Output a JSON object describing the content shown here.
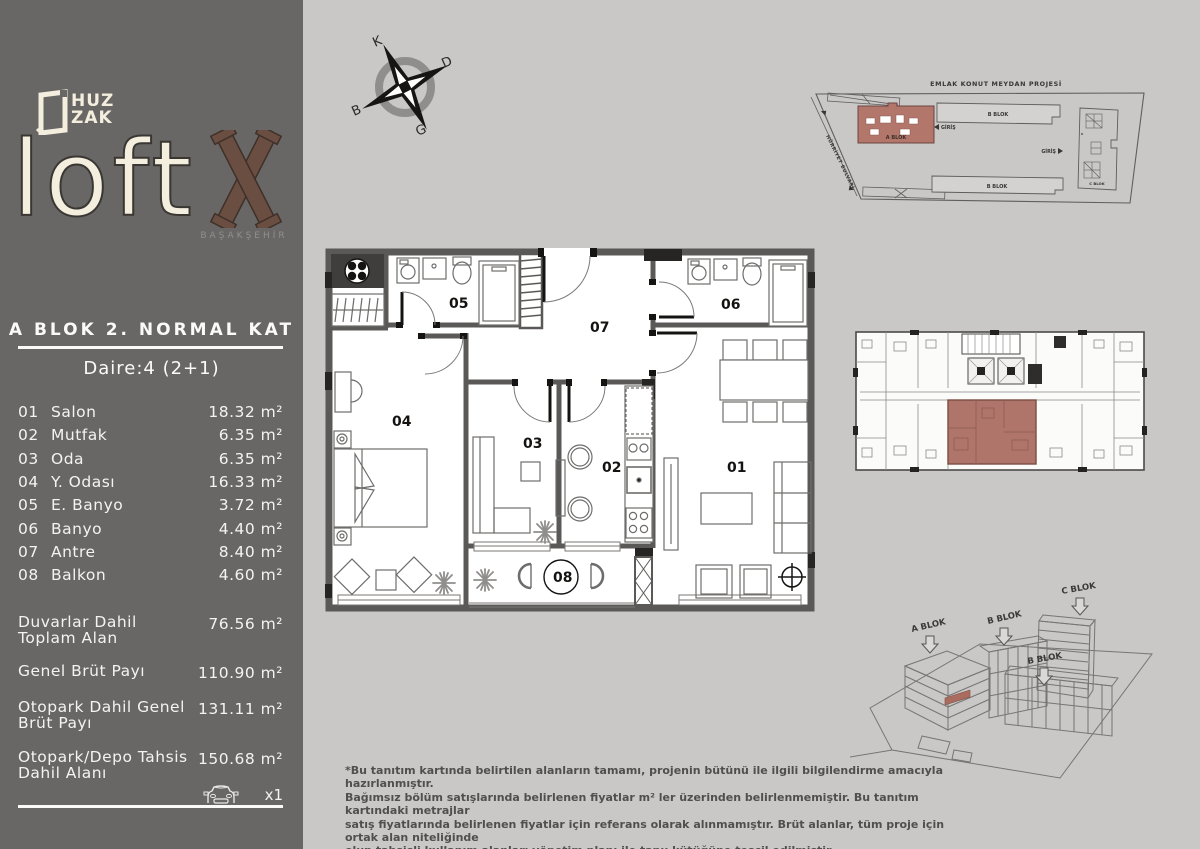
{
  "brand": {
    "huz": "HUZ",
    "zak": "ZAK",
    "loft": "loft",
    "mark": "X",
    "city": "BAŞAKŞEHİR"
  },
  "header": {
    "title": "A BLOK 2. NORMAL KAT",
    "subtitle": "Daire:4 (2+1)"
  },
  "rooms": [
    {
      "num": "01",
      "name": "Salon",
      "area": "18.32 m²"
    },
    {
      "num": "02",
      "name": "Mutfak",
      "area": "6.35 m²"
    },
    {
      "num": "03",
      "name": "Oda",
      "area": "6.35 m²"
    },
    {
      "num": "04",
      "name": "Y. Odası",
      "area": "16.33 m²"
    },
    {
      "num": "05",
      "name": "E. Banyo",
      "area": "3.72 m²"
    },
    {
      "num": "06",
      "name": "Banyo",
      "area": "4.40 m²"
    },
    {
      "num": "07",
      "name": "Antre",
      "area": "8.40 m²"
    },
    {
      "num": "08",
      "name": "Balkon",
      "area": "4.60 m²"
    }
  ],
  "totals": [
    {
      "line1": "Duvarlar Dahil",
      "line2": "Toplam Alan",
      "value": "76.56 m²"
    },
    {
      "line1": "Genel Brüt Payı",
      "line2": "",
      "value": "110.90 m²"
    },
    {
      "line1": "Otopark Dahil Genel",
      "line2": "Brüt Payı",
      "value": "131.11 m²"
    },
    {
      "line1": "Otopark/Depo Tahsis",
      "line2": "Dahil Alanı",
      "value": "150.68 m²"
    }
  ],
  "parking": {
    "count": "x1"
  },
  "compass": {
    "n": "K",
    "e": "D",
    "s": "G",
    "w": "B"
  },
  "plan": {
    "r1": "01",
    "r2": "02",
    "r3": "03",
    "r4": "04",
    "r5": "05",
    "r6": "06",
    "r7": "07",
    "r8": "08"
  },
  "site_plan": {
    "title": "EMLAK KONUT MEYDAN PROJESİ",
    "a_blok": "A BLOK",
    "b_blok_top": "B BLOK",
    "b_blok_bottom": "B BLOK",
    "c_blok": "C BLOK",
    "giris_left": "GİRİŞ",
    "giris_right": "GİRİŞ",
    "street": "HÜRRİYET BULVARI"
  },
  "axon": {
    "a_blok": "A BLOK",
    "b_blok": "B BLOK",
    "c_blok": "C BLOK",
    "b_blok2": "B BLOK"
  },
  "disclaimer": {
    "line1": "*Bu tanıtım kartında belirtilen alanların tamamı, projenin bütünü ile ilgili bilgilendirme amacıyla hazırlanmıştır.",
    "line2": "Bağımsız bölüm satışlarında belirlenen fiyatlar m² ler üzerinden belirlenmemiştir. Bu tanıtım kartındaki metrajlar",
    "line3": "satış fiyatlarında belirlenen fiyatlar için referans olarak alınmamıştır. Brüt alanlar, tüm proje için ortak alan niteliğinde",
    "line4": "olup tahsisli kullanım alanları yönetim planı ile tapu kütüğüne tescil edilmiştir."
  },
  "colors": {
    "sidebar": "#696765",
    "background": "#c9c8c6",
    "highlight": "#b0756a",
    "cream": "#f3eede",
    "wood": "#6a4e42"
  }
}
